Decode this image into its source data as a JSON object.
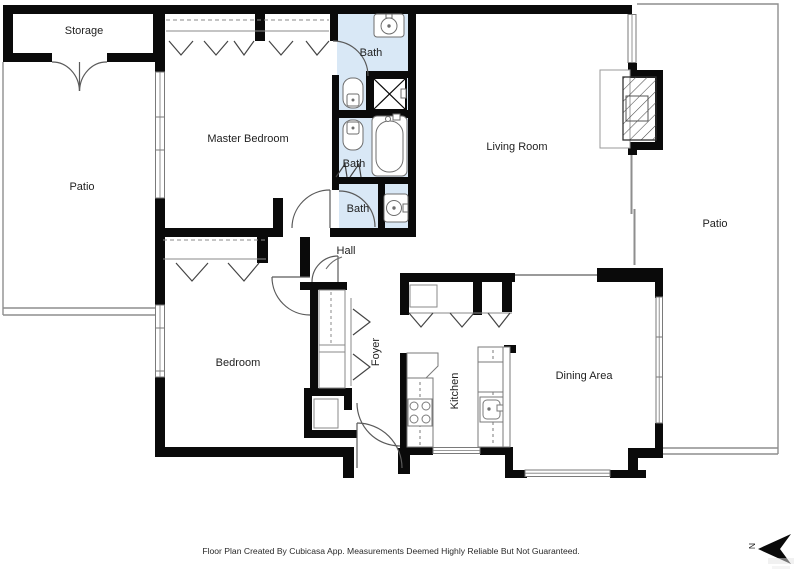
{
  "document": {
    "type": "floor-plan",
    "creator_note": "Floor Plan Created By Cubicasa App. Measurements Deemed Highly Reliable But Not Guaranteed."
  },
  "rooms": {
    "storage": {
      "label": "Storage"
    },
    "patio_left": {
      "label": "Patio"
    },
    "master_bedroom": {
      "label": "Master Bedroom"
    },
    "bath_top": {
      "label": "Bath"
    },
    "bath_middle": {
      "label": "Bath"
    },
    "bath_lower": {
      "label": "Bath"
    },
    "living_room": {
      "label": "Living Room"
    },
    "patio_right": {
      "label": "Patio"
    },
    "hall": {
      "label": "Hall"
    },
    "bedroom": {
      "label": "Bedroom"
    },
    "foyer": {
      "label": "Foyer"
    },
    "kitchen": {
      "label": "Kitchen"
    },
    "dining_area": {
      "label": "Dining Area"
    }
  },
  "compass": {
    "north_label": "N"
  },
  "footer": {
    "disclaimer": "Floor Plan Created By Cubicasa App. Measurements Deemed Highly Reliable But Not Guaranteed."
  },
  "colors": {
    "wall": "#0a0a0a",
    "bath_fill": "#d9e8f6",
    "thin_line": "#8e8e8e",
    "fixture_line": "#6e6e6e",
    "text": "#1f1f1f"
  }
}
